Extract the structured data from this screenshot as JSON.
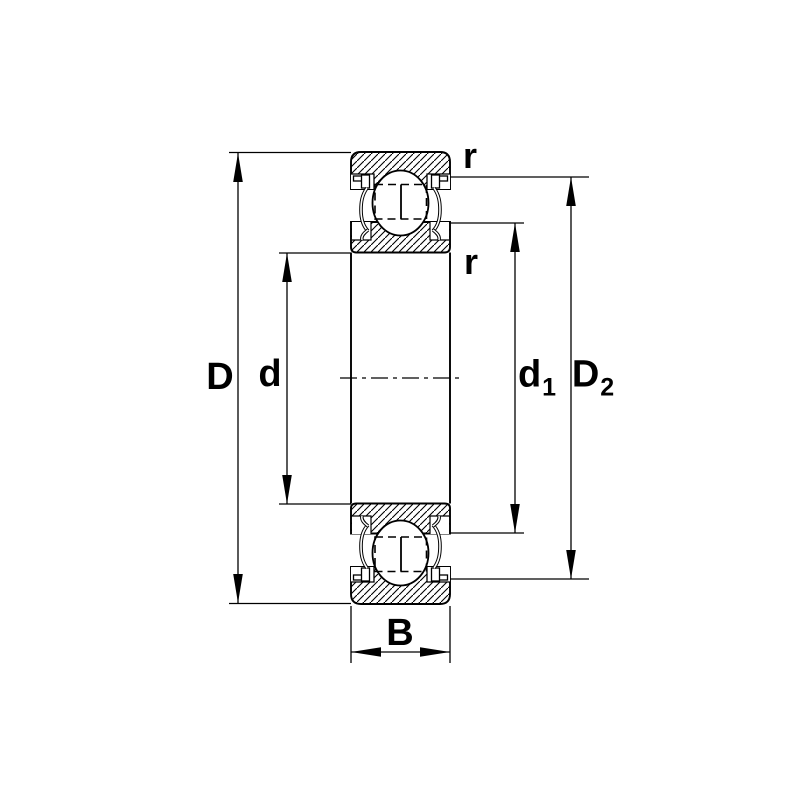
{
  "figure": {
    "background_color": "#ffffff",
    "line_color": "#000000"
  },
  "labels": {
    "outer_diameter": "D",
    "bore_diameter": "d",
    "d1_base": "d",
    "d1_sub": "1",
    "D2_base": "D",
    "D2_sub": "2",
    "width": "B",
    "r_top": "r",
    "r_bottom": "r"
  }
}
